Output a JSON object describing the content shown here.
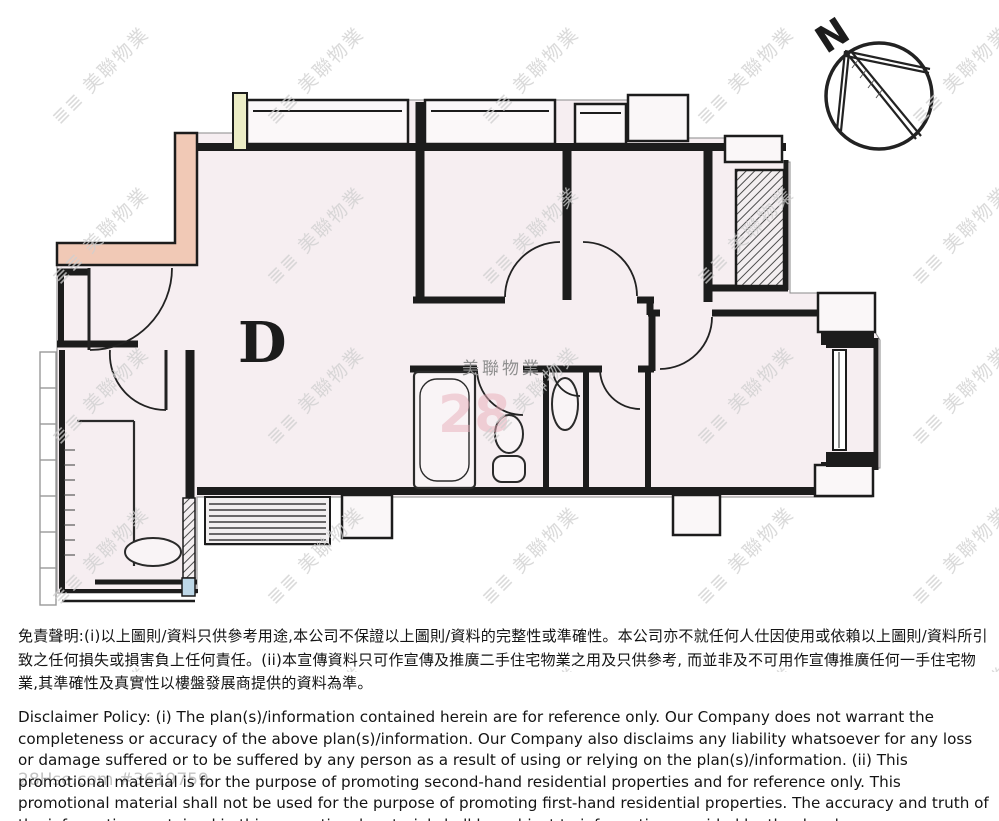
{
  "floor_plan": {
    "unit_label": "D",
    "compass_label": "N"
  },
  "watermarks": {
    "tile": "≣≣ 美聯物業",
    "brand_center": "美聯物業",
    "pink_number": "28",
    "listing_ref": "28Hse.com #3619759"
  },
  "disclaimer": {
    "chinese": "免責聲明:(i)以上圖則/資料只供參考用途,本公司不保證以上圖則/資料的完整性或準確性。本公司亦不就任何人仕因使用或依賴以上圖則/資料所引致之任何損失或損害負上任何責任。(ii)本宣傳資料只可作宣傳及推廣二手住宅物業之用及只供參考, 而並非及不可用作宣傳推廣任何一手住宅物業,其準確性及真實性以樓盤發展商提供的資料為準。",
    "english": "Disclaimer Policy: (i) The plan(s)/information contained herein are for reference only. Our Company does not warrant the completeness or accuracy of the above plan(s)/information. Our Company also disclaims any liability whatsoever for any loss or damage suffered or to be suffered by any person as a result of using or relying on the plan(s)/information. (ii) This promotional material is for the purpose of promoting second-hand residential properties and for reference only. This promotional material shall not be used for the purpose of promoting first-hand residential properties. The accuracy and truth of the information contained in this promotional material shall be subject to information provided by the developers."
  },
  "colors": {
    "wall": "#1c1c1c",
    "floor": "#f6eef1",
    "highlight_wall": "#f1c9b6",
    "duct_yellow": "#ecedc6",
    "blue_tile": "#bdd7e7",
    "watermark_gray": "#cfcfcf",
    "pink_watermark": "#e9aeb9"
  }
}
